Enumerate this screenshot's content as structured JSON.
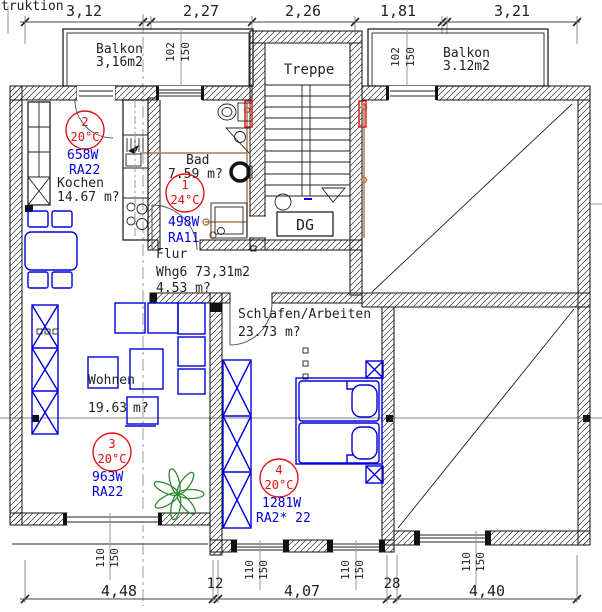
{
  "header": {
    "partial_text": "truktion"
  },
  "dims": {
    "top": [
      "3,12",
      "2,27",
      "2,26",
      "1,81",
      "3,21"
    ],
    "bottom": [
      "4,48",
      "12",
      "4,07",
      "28",
      "4,40"
    ]
  },
  "marks": {
    "w102": "102",
    "w110": "110",
    "w150": "150"
  },
  "rooms": {
    "balkon_left": {
      "name": "Balkon",
      "area": "3,16m2"
    },
    "balkon_right": {
      "name": "Balkon",
      "area": "3.12m2"
    },
    "treppe": {
      "name": "Treppe"
    },
    "dg_label": "DG",
    "bad": {
      "name": "Bad",
      "area": "7.59 m?"
    },
    "kochen": {
      "name": "Kochen",
      "area": "14.67 m?"
    },
    "flur": {
      "name": "Flur",
      "apartment": "Whg6 73,31m2",
      "area": "4.53 m?"
    },
    "wohnen": {
      "name": "Wohnen",
      "area_value": "19.63",
      "area_unit": "m?"
    },
    "schlafen": {
      "name": "Schlafen/Arbeiten",
      "area": "23.73 m?"
    }
  },
  "radiators": [
    {
      "id": "1",
      "temp": "24°C",
      "power": "498W",
      "type": "RA11"
    },
    {
      "id": "2",
      "temp": "20°C",
      "power": "658W",
      "type": "RA22"
    },
    {
      "id": "3",
      "temp": "20°C",
      "power": "963W",
      "type": "RA22"
    },
    {
      "id": "4",
      "temp": "20°C",
      "power": "1281W",
      "type": "RA2* 22"
    }
  ],
  "colors": {
    "heating_red": "#e01010",
    "furniture_blue": "#0000dd",
    "plant_green": "#2e8b2e",
    "pipe_brown": "#b07a50",
    "wall_black": "#111111"
  }
}
